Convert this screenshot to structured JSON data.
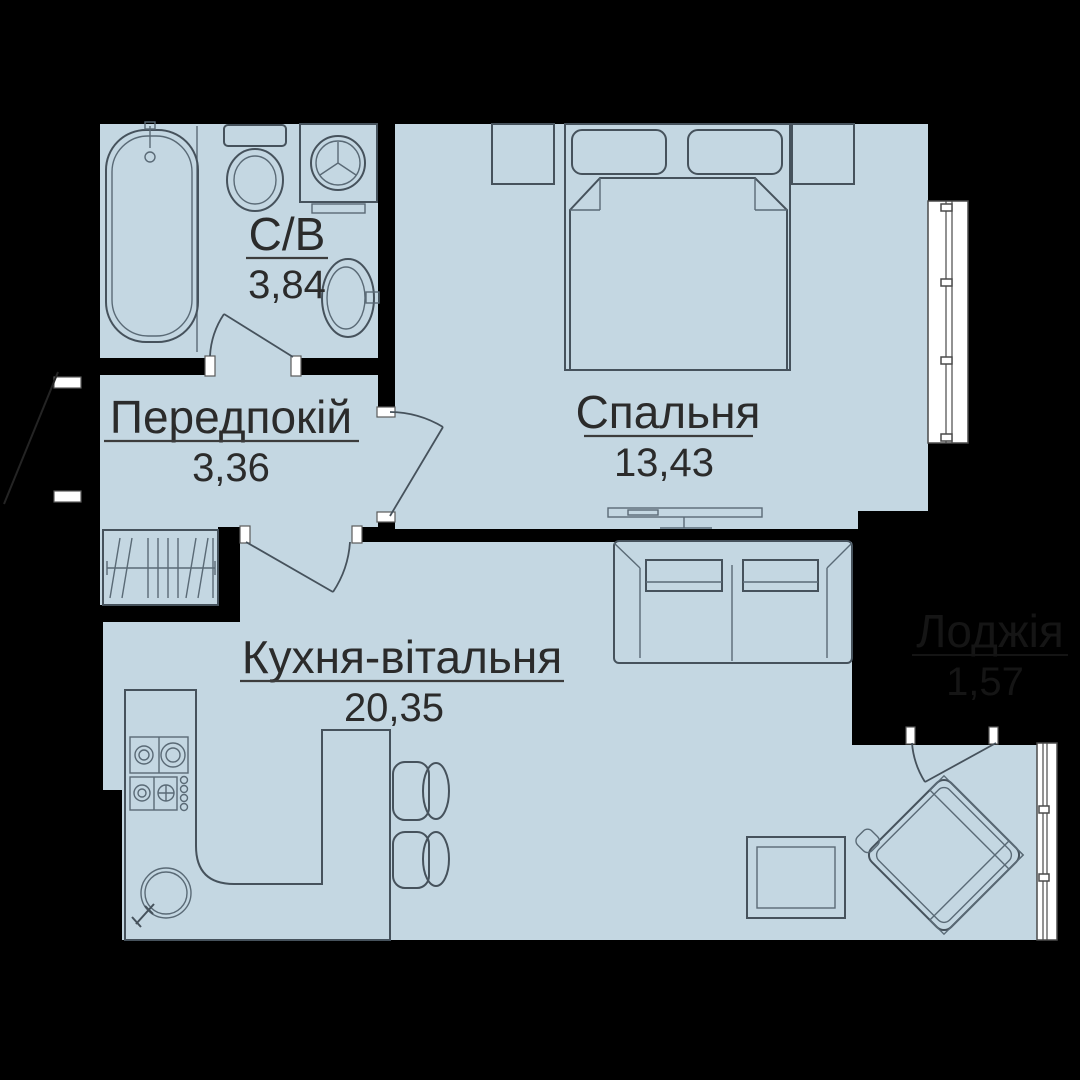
{
  "plan": {
    "title": "apartment-floor-plan",
    "rooms": {
      "bathroom": {
        "label": "С/В",
        "area": "3,84"
      },
      "hallway": {
        "label": "Передпокій",
        "area": "3,36"
      },
      "bedroom": {
        "label": "Спальня",
        "area": "13,43"
      },
      "kitchen_living": {
        "label": "Кухня-вітальня",
        "area": "20,35"
      },
      "loggia": {
        "label": "Лоджія",
        "area": "1,57"
      }
    },
    "colors": {
      "wall": "#000000",
      "floor": "#c4d7e2",
      "furniture_line": "#46525c",
      "label_text": "#2b2b2b",
      "loggia_text": "#151515",
      "window": "#ffffff"
    },
    "furniture_icons": [
      "bathtub",
      "toilet",
      "washing-machine",
      "bathroom-sink",
      "wardrobe",
      "double-bed",
      "nightstand",
      "tv-stand",
      "sofa",
      "coffee-table",
      "armchair",
      "kitchen-counter",
      "stove",
      "kitchen-sink",
      "bar-table",
      "chair"
    ]
  }
}
